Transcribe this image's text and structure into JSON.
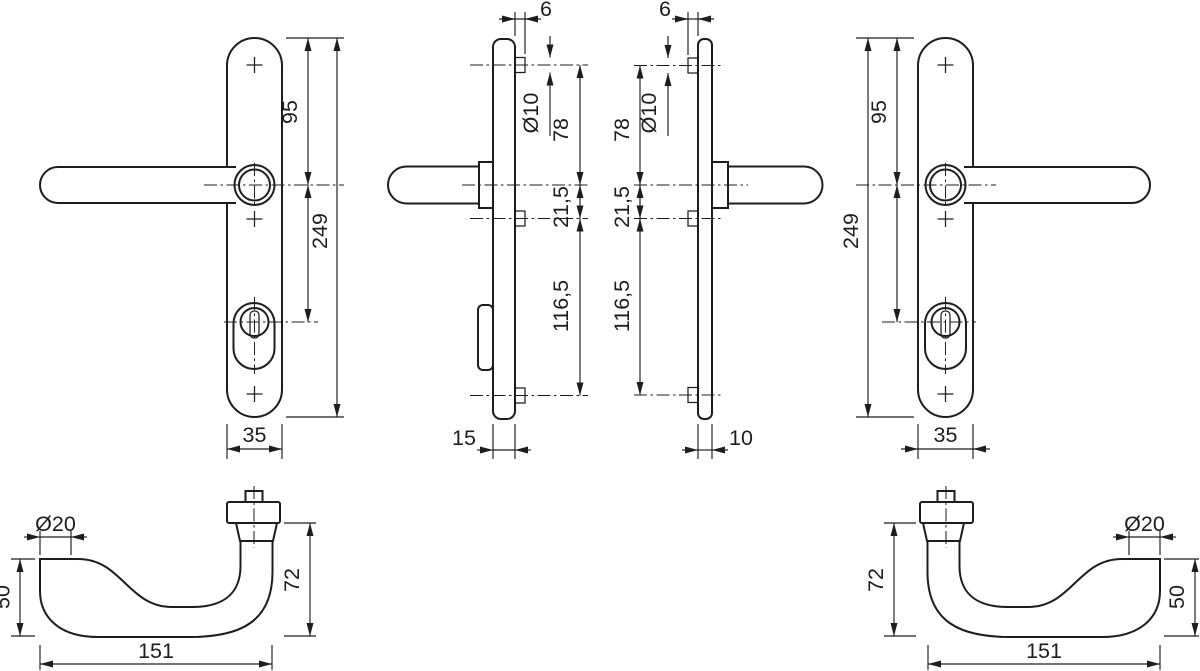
{
  "page": {
    "background": "#ffffff",
    "line_color": "#1d1d1d"
  },
  "views": {
    "backplate_front_outside": {
      "length": "249",
      "handle_center_from_top": "95",
      "width": "35"
    },
    "backplate_side_outside": {
      "fixing_projection": "6",
      "fixing_diameter": "Ø10",
      "fixing_to_handle": "78",
      "handle_to_fixing": "21,5",
      "fixing_spacing": "116,5",
      "depth": "15"
    },
    "backplate_side_inside": {
      "fixing_projection": "6",
      "fixing_diameter": "Ø10",
      "fixing_to_handle": "78",
      "handle_to_fixing": "21,5",
      "fixing_spacing": "116,5",
      "depth": "10"
    },
    "backplate_front_inside": {
      "length": "249",
      "handle_center_from_top": "95",
      "width": "35"
    },
    "lever_left": {
      "grip_diameter": "Ø20",
      "grip_height": "50",
      "projection": "72",
      "length": "151"
    },
    "lever_right": {
      "grip_diameter": "Ø20",
      "grip_height": "50",
      "projection": "72",
      "length": "151"
    }
  }
}
